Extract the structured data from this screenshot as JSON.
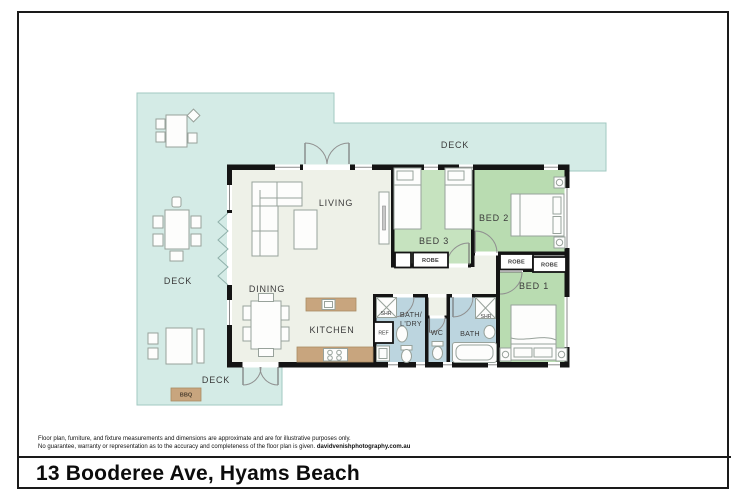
{
  "page": {
    "title": "13 Booderee Ave, Hyams Beach",
    "disclaimer_line1": "Floor plan, furniture, and fixture measurements and dimensions are approximate and are for illustrative purposes only.",
    "disclaimer_line2": "No guarantee, warranty or representation as to the accuracy and completeness of the floor plan is given.",
    "credit": "davidvenishphotography.com.au"
  },
  "plan": {
    "labels": {
      "deck_top": "DECK",
      "deck_left": "DECK",
      "deck_bottom": "DECK",
      "living": "LIVING",
      "dining": "DINING",
      "kitchen": "KITCHEN",
      "bed1": "BED 1",
      "bed2": "BED 2",
      "bed3": "BED 3",
      "robe_bed3": "ROBE",
      "robe_bed1_a": "ROBE",
      "robe_bed1_b": "ROBE",
      "bath_ldry_line1": "BATH/",
      "bath_ldry_line2": "L'DRY",
      "wc": "WC",
      "bath": "BATH",
      "shr_ldry": "SHR",
      "shr_bath": "SHR",
      "ref": "REF",
      "bbq": "BBQ"
    },
    "colors": {
      "deck": "#d4ebe6",
      "floor": "#eef1e8",
      "bedroom": "#b9dcb1",
      "bedroom_light": "#c6e3bf",
      "bathroom": "#bcd5df",
      "wall": "#141414",
      "bench": "#c8a57e"
    }
  }
}
